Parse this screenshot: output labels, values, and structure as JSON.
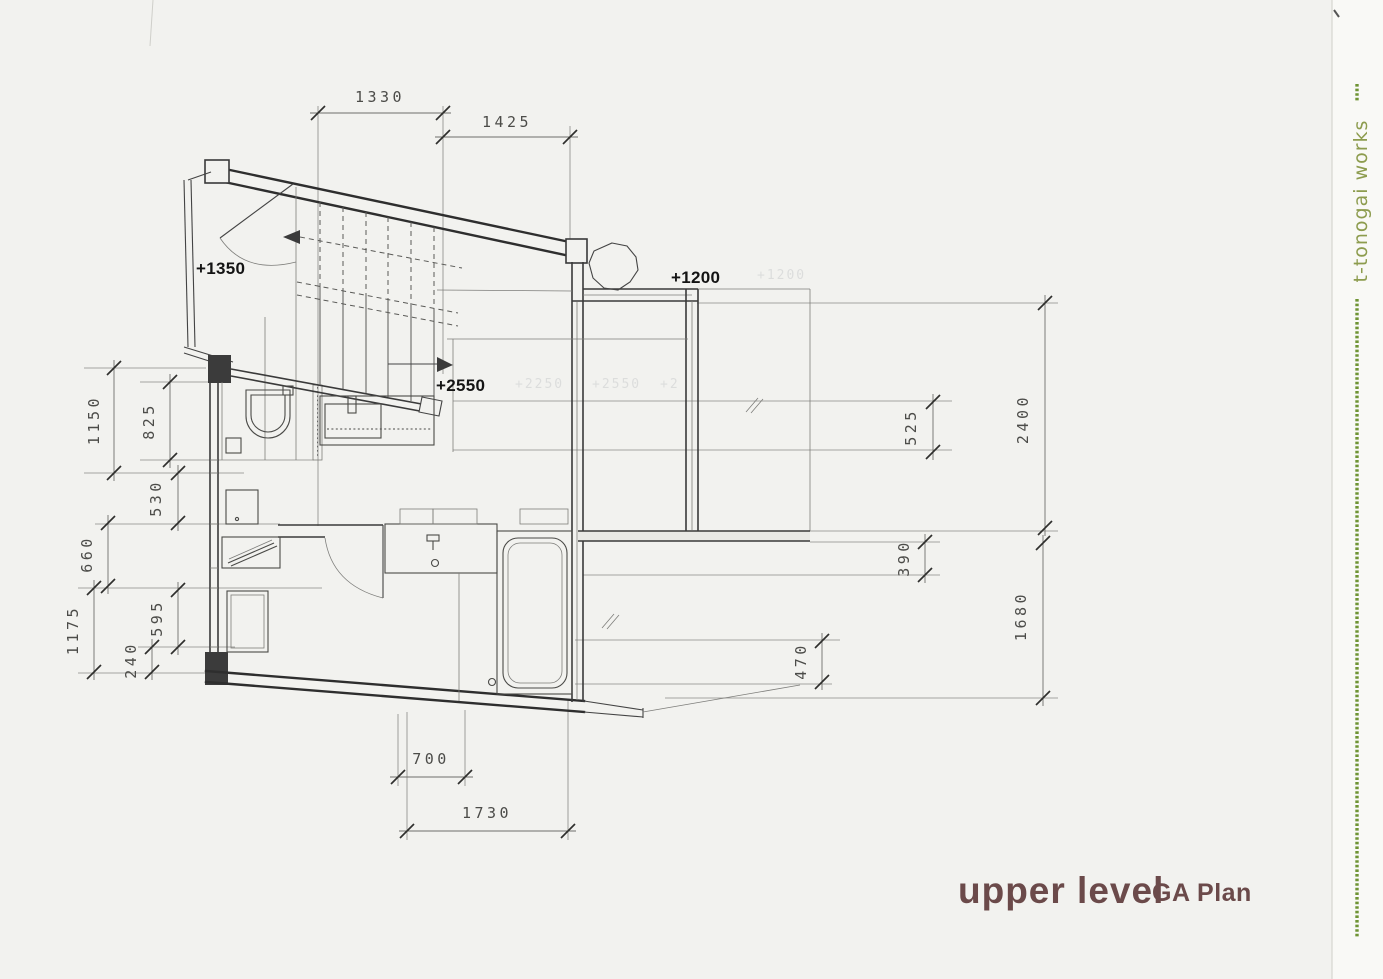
{
  "drawing": {
    "levels": {
      "room": "+1350",
      "terrace": "+1200",
      "stair": "+2550"
    },
    "dims": {
      "top_1330": "1330",
      "top_1425": "1425",
      "left_1150": "1150",
      "left_825": "825",
      "left_530": "530",
      "left_660": "660",
      "left_1175": "1175",
      "left_595": "595",
      "left_240": "240",
      "right_525": "525",
      "right_2400": "2400",
      "right_390": "390",
      "right_1680": "1680",
      "right_470": "470",
      "bottom_700": "700",
      "bottom_1730": "1730"
    },
    "ghost_marks": {
      "g1": "+2250",
      "g2": "+2550",
      "g3": "+2",
      "g4": "+1200"
    }
  },
  "title": {
    "main": "upper level",
    "sub": "GA Plan"
  },
  "brand": {
    "text": "t-tonogai works",
    "text_color": "#8d9c4e",
    "rule_color": "#6f9434"
  },
  "colors": {
    "paper": "#f2f2ef",
    "ink": "#2e2e2e",
    "dimension": "#4c4c49",
    "title": "#6b4a4a"
  }
}
